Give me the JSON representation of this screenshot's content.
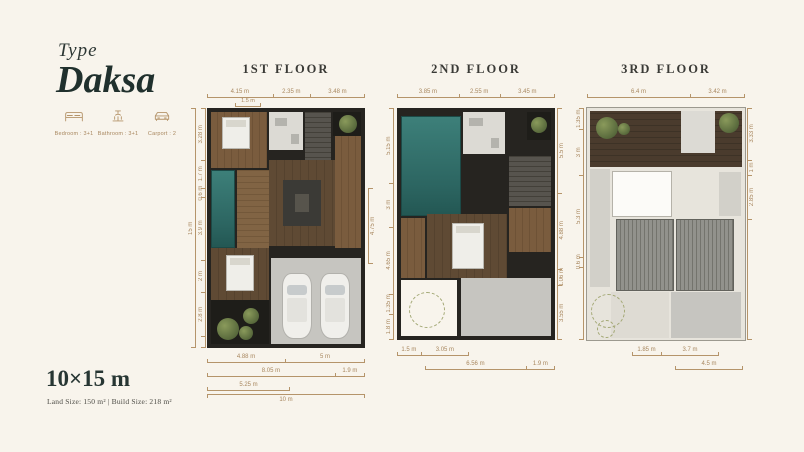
{
  "brand": {
    "type_label": "Type",
    "name": "Daksa"
  },
  "features": [
    {
      "icon": "bed-icon",
      "label": "Bedroom : 3+1"
    },
    {
      "icon": "bath-icon",
      "label": "Bathroom : 3+1"
    },
    {
      "icon": "car-icon",
      "label": "Carport : 2"
    }
  ],
  "size": {
    "dimensions": "10×15 m",
    "detail": "Land Size: 150 m² | Build Size: 218 m²"
  },
  "floors": [
    {
      "title": "1ST FLOOR",
      "top_dims": [
        "4.15 m",
        "2.35 m",
        "3.48 m"
      ],
      "top_sub_dim": "1.5 m",
      "left_outer_dim": "15 m",
      "left_dims": [
        "3.28 m",
        "1.7 m",
        "0.6 m",
        "3.9 m",
        "2 m",
        "2.8 m"
      ],
      "right_dims": [
        "4.75 m"
      ],
      "bottom_row1": [
        "4.88 m",
        "5 m"
      ],
      "bottom_row2": [
        "8.05 m",
        "1.9 m"
      ],
      "bottom_row3": [
        "5.25 m"
      ],
      "bottom_overall": "10 m"
    },
    {
      "title": "2ND FLOOR",
      "top_dims": [
        "3.85 m",
        "2.55 m",
        "3.45 m"
      ],
      "left_dims": [
        "5.15 m",
        "3 m",
        "4.65 m",
        "1.35 m",
        "1.8 m"
      ],
      "right_dims": [
        "5.5 m",
        "4.88 m",
        "1.06 m",
        "3.55 m"
      ],
      "bottom_row1": [
        "1.5 m",
        "3.05 m"
      ],
      "bottom_row2": [
        "6.56 m",
        "1.9 m"
      ]
    },
    {
      "title": "3RD FLOOR",
      "top_dims": [
        "6.4 m",
        "3.42 m"
      ],
      "left_dims": [
        "1.35 m",
        "3 m",
        "5.3 m",
        "0.6 m"
      ],
      "right_dims": [
        "3.33 m",
        "1 m",
        "2.85 m"
      ],
      "bottom_row1": [
        "1.85 m",
        "3.7 m"
      ],
      "bottom_row2": [
        "4.5 m"
      ]
    }
  ],
  "colors": {
    "background": "#f8f4ec",
    "accent": "#b5946a",
    "ink": "#2d3734",
    "pool": "#2f6f6b",
    "wood": "#755839",
    "greenery": "#6f7c49"
  }
}
